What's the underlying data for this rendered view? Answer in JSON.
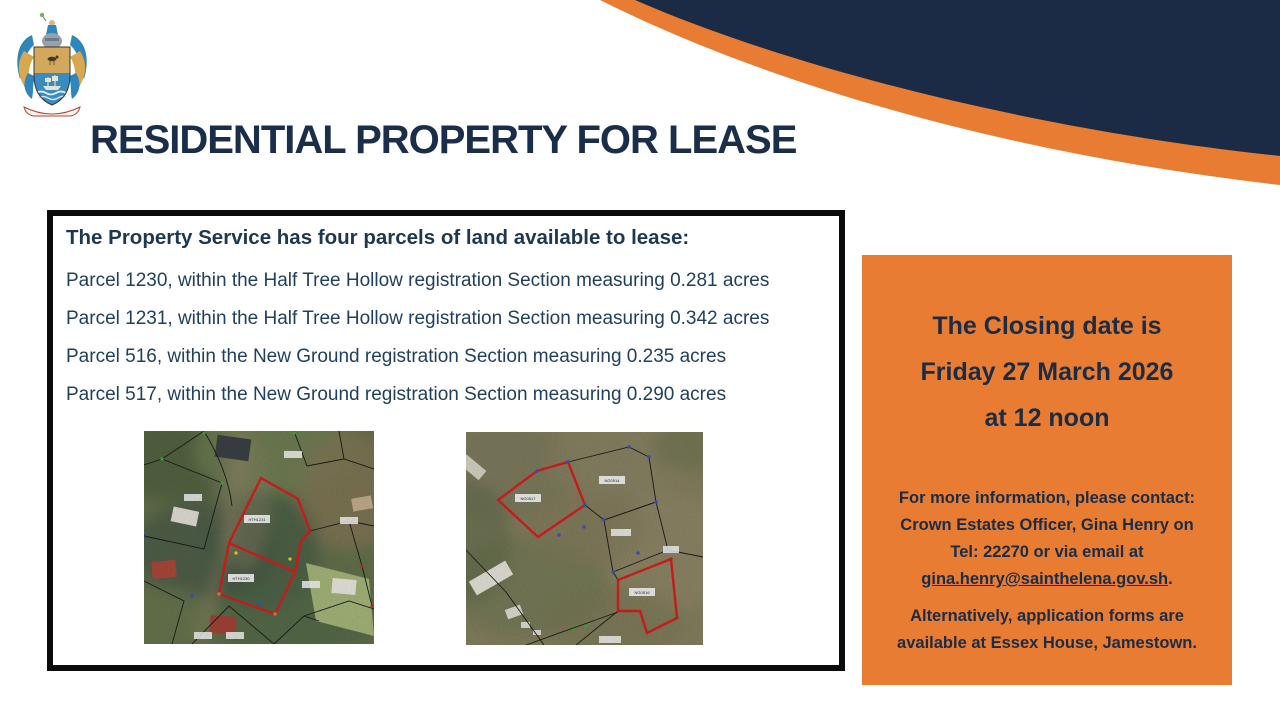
{
  "header": {
    "title": "RESIDENTIAL PROPERTY FOR LEASE",
    "colors": {
      "navy": "#1b2b45",
      "orange": "#e87c33"
    },
    "crest": "st-helena-coat-of-arms"
  },
  "notice_box": {
    "heading": "The Property Service has four parcels of land available to lease:",
    "parcels": [
      "Parcel 1230, within the Half Tree Hollow registration Section measuring 0.281 acres",
      "Parcel 1231, within the Half Tree Hollow registration Section measuring 0.342 acres",
      "Parcel 516, within the New Ground registration Section measuring 0.235 acres",
      "Parcel 517, within the New Ground registration Section measuring 0.290 acres"
    ]
  },
  "maps": {
    "left": {
      "name": "half-tree-hollow-aerial-map",
      "labels": [
        "HTH1231",
        "HTH1230"
      ]
    },
    "right": {
      "name": "new-ground-aerial-map",
      "labels": [
        "NG0517",
        "NG0514",
        "NG0516"
      ]
    }
  },
  "closing_panel": {
    "closing_lines": [
      "The Closing date is",
      "Friday 27 March 2026",
      "at 12 noon"
    ],
    "contact_lines": [
      "For more information, please contact:",
      "Crown Estates Officer, Gina Henry on",
      "Tel: 22270 or via email at"
    ],
    "email": "gina.henry@sainthelena.gov.sh",
    "email_suffix": ".",
    "alt_lines": [
      "Alternatively, application forms are",
      "available at Essex House, Jamestown."
    ]
  }
}
